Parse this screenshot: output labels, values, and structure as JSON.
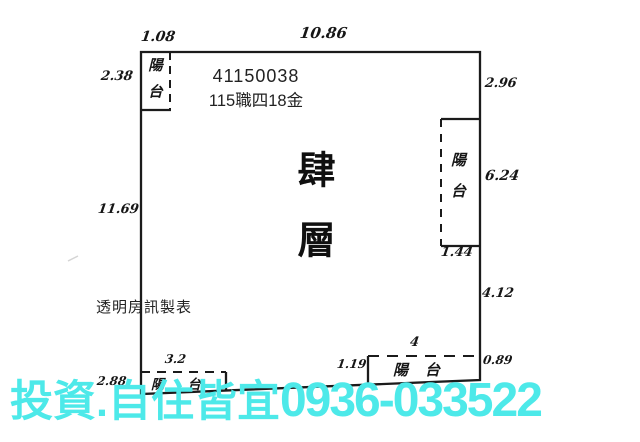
{
  "plan": {
    "header": {
      "id_number": "41150038",
      "case_code": "115職四18金"
    },
    "floor_title": "肆層",
    "maker_label": "透明房訊製表",
    "balconies": {
      "top_left": "陽台",
      "right": "陽台",
      "bottom_left": "陽台",
      "bottom_right": "陽台"
    },
    "dimensions": {
      "top_left_width": "1.08",
      "top_width": "10.86",
      "left_upper": "2.38",
      "left_height": "11.69",
      "right_upper": "2.96",
      "right_balcony_height": "6.24",
      "right_balcony_depth": "1.44",
      "right_lower": "4.12",
      "right_bottom": "0.89",
      "bottom_balcony_width": "4",
      "bottom_gap": "1.19",
      "bottom_left_balcony_width": "3.2",
      "bottom_left_offset": "2.88"
    }
  },
  "watermark": {
    "text": "投資.自住皆宜",
    "phone": "0936-033522",
    "color": "#4de9e9"
  },
  "colors": {
    "background": "#ffffff",
    "line": "#1b1b1b",
    "watermark": "#4de9e9"
  }
}
